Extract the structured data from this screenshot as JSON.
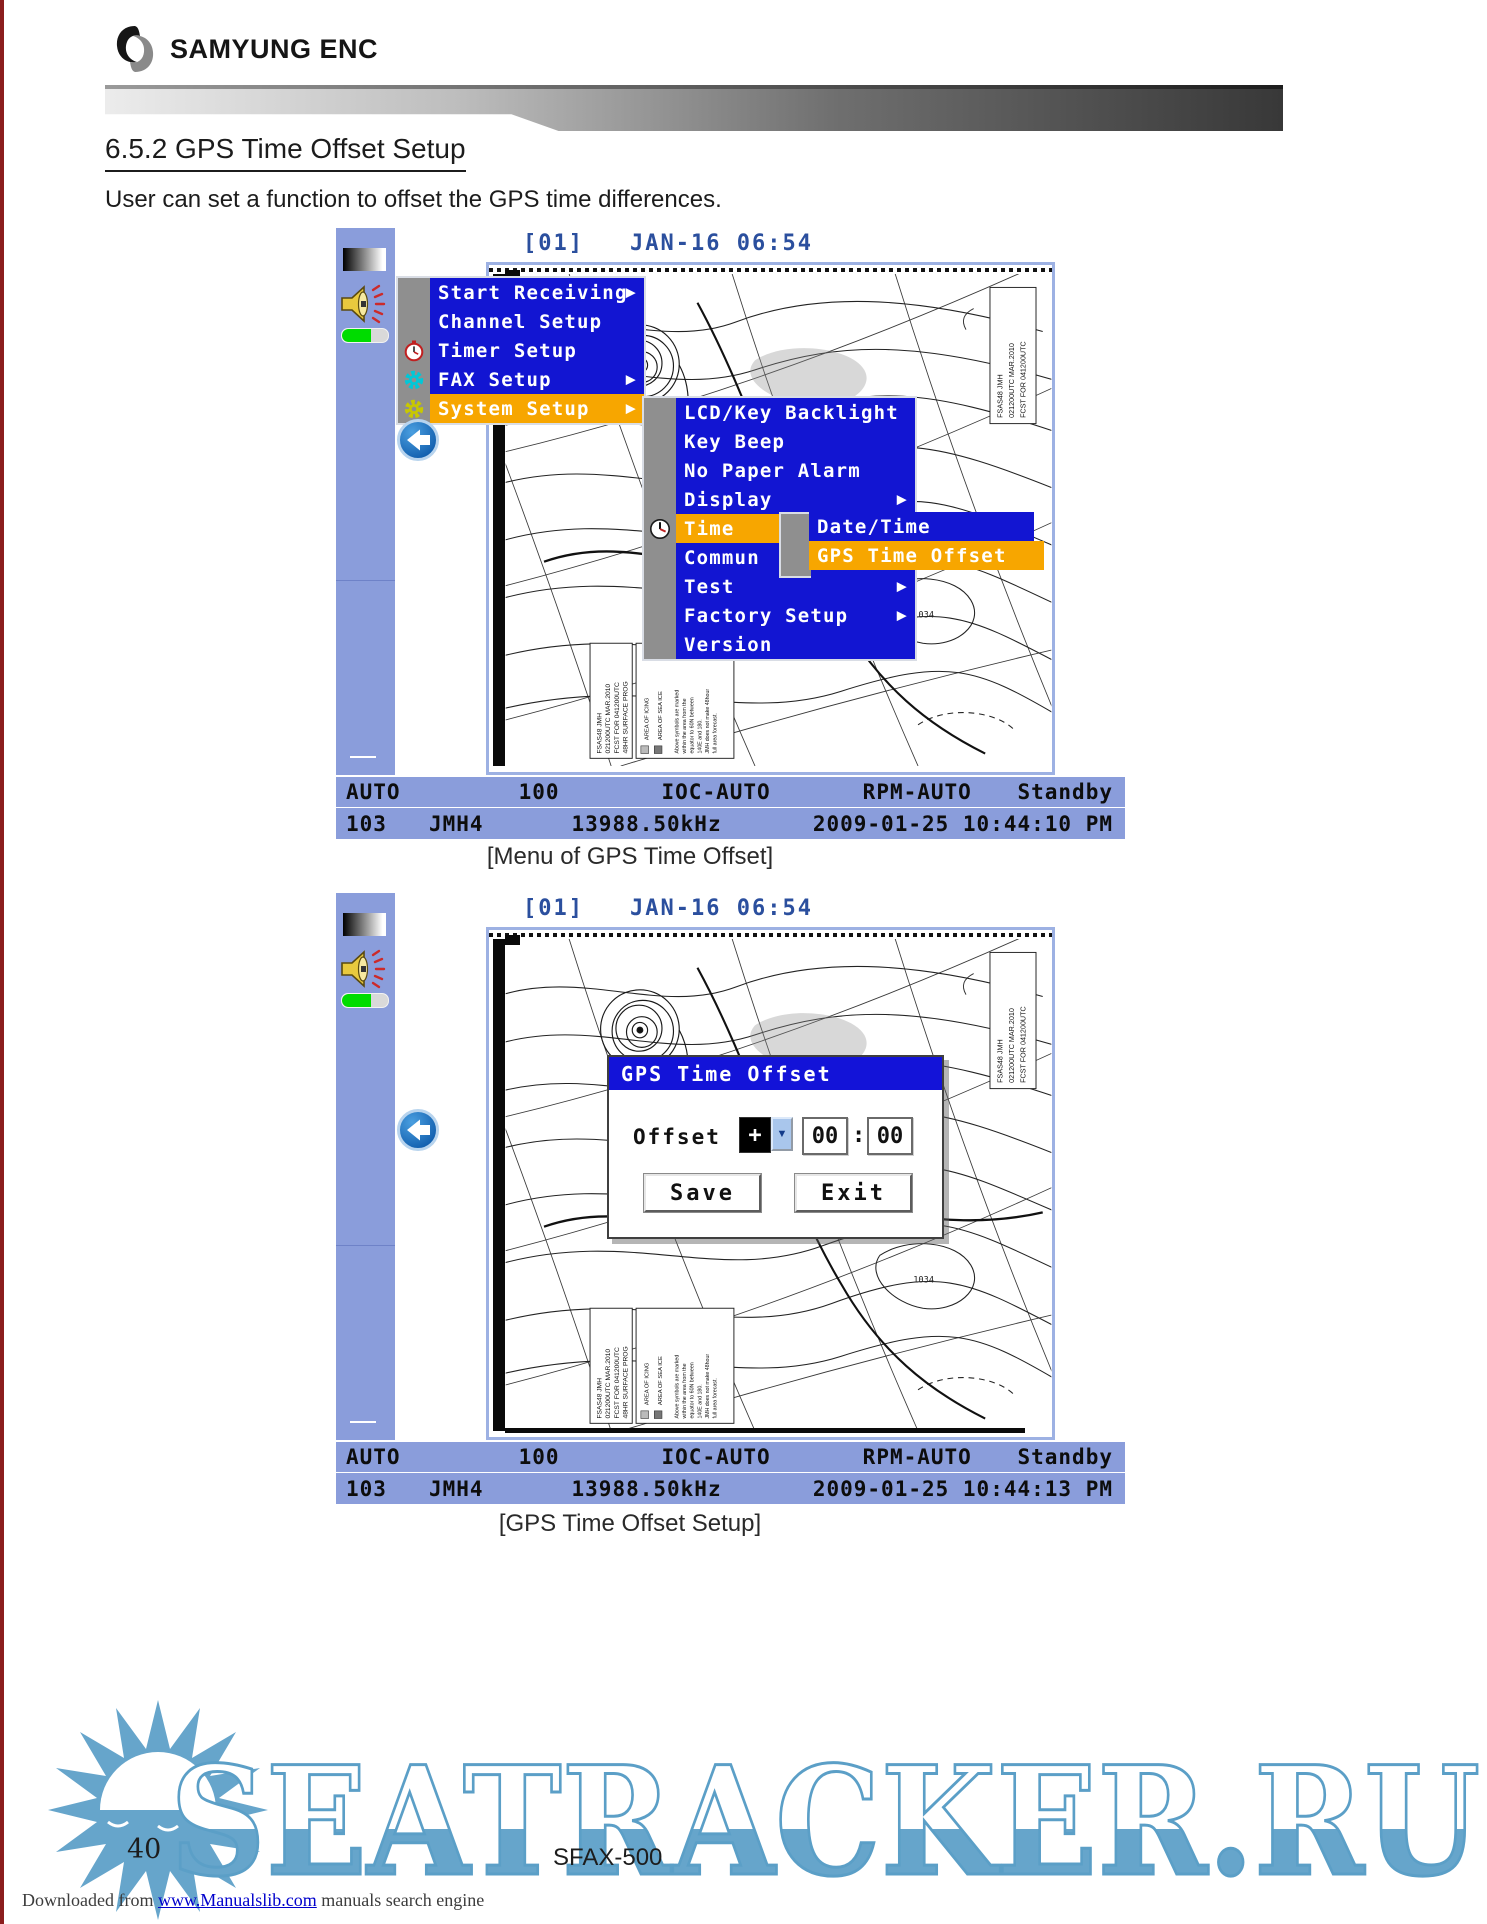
{
  "header": {
    "brand": "SAMYUNG ENC"
  },
  "section": {
    "title": "6.5.2 GPS Time Offset Setup",
    "body": "User can set a function to offset the GPS time differences."
  },
  "captions": {
    "screenshot1": "[Menu of GPS Time Offset]",
    "screenshot2": "[GPS Time Offset Setup]"
  },
  "glyphs": {
    "arrow": "▶",
    "dropdown": "▼"
  },
  "device": {
    "screen_header": {
      "channel": "[01]",
      "datetime": "JAN-16 06:54"
    },
    "main_menu": {
      "items": [
        {
          "label": "Start Receiving"
        },
        {
          "label": "Channel Setup"
        },
        {
          "label": "Timer Setup"
        },
        {
          "label": "FAX Setup"
        },
        {
          "label": "System Setup"
        }
      ]
    },
    "system_submenu": {
      "items": [
        {
          "label": "LCD/Key Backlight"
        },
        {
          "label": "Key Beep"
        },
        {
          "label": "No Paper Alarm"
        },
        {
          "label": "Display"
        },
        {
          "label": "Time"
        },
        {
          "label": "Commun"
        },
        {
          "label": "Test"
        },
        {
          "label": "Factory Setup"
        },
        {
          "label": "Version"
        }
      ]
    },
    "time_submenu": {
      "items": [
        {
          "label": "Date/Time"
        },
        {
          "label": "GPS Time Offset"
        }
      ]
    },
    "dialog": {
      "title": "GPS Time Offset",
      "offset_label": "Offset",
      "sign_value": "+",
      "hours_value": "00",
      "separator": ":",
      "minutes_value": "00",
      "save_label": "Save",
      "exit_label": "Exit"
    },
    "status_row1": {
      "mode": "AUTO",
      "speed": "100",
      "ioc": "IOC-AUTO",
      "rpm": "RPM-AUTO",
      "state": "Standby"
    },
    "status_row2": {
      "channel": "103",
      "station": "JMH4",
      "frequency": "13988.50kHz",
      "datetime1": "2009-01-25 10:44:10 PM",
      "datetime2": "2009-01-25 10:44:13 PM"
    },
    "fax": {
      "id_box_lines": [
        "FSAS48  JMH",
        "021200UTC MAR.2010",
        "FCST FOR 041200UTC"
      ],
      "legend_box_lines": [
        "FSAS48  JMH",
        "021200UTC MAR.2010",
        "FCST FOR 041200UTC",
        "48HR SURFACE PROG"
      ],
      "area_lines": [
        "AREA OF ICING",
        "AREA OF SEA ICE"
      ],
      "note_lines": [
        "Above symbols are marked",
        "within the area from the",
        "equator to 60N between",
        "140E and 180.",
        "JMH does not make 48hour",
        "full area forecast."
      ],
      "isobar_labels": [
        "1024",
        "1034"
      ]
    }
  },
  "footer": {
    "page_number": "40",
    "model": "SFAX-500",
    "watermark": "SEATRACKER.RU",
    "downloaded_prefix": "Downloaded from",
    "downloaded_link": "www.Manualslib.com",
    "downloaded_suffix": " manuals search engine"
  },
  "colors": {
    "panel_blue": "#8A9DDB",
    "menu_blue": "#1215D2",
    "highlight_orange": "#F7A600",
    "strip_gray": "#8F8F8F",
    "header_text_blue": "#2B4F9E",
    "dialog_title_blue": "#1313D8",
    "watermark_blue": "#66A5CB",
    "volume_green": "#00DC00"
  }
}
